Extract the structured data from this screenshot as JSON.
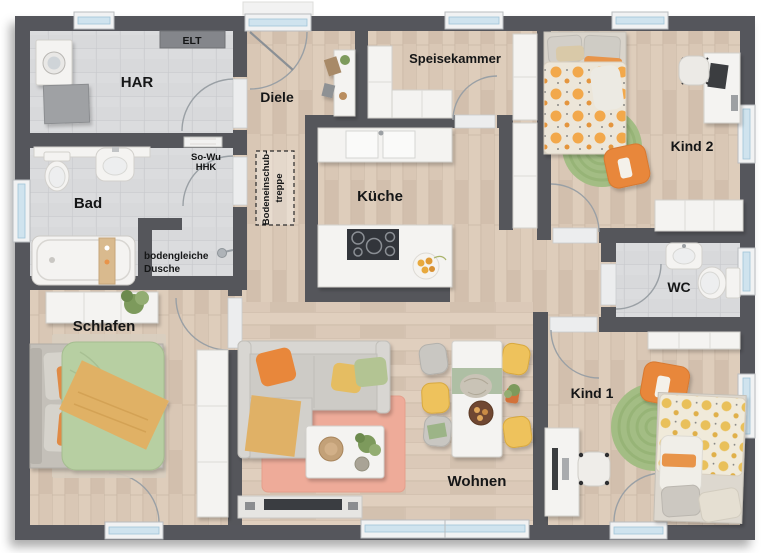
{
  "plan": {
    "rooms": {
      "har": {
        "label": "HAR"
      },
      "diele": {
        "label": "Diele"
      },
      "speisekammer": {
        "label": "Speisekammer"
      },
      "kueche": {
        "label": "Küche"
      },
      "bad": {
        "label": "Bad"
      },
      "schlafen": {
        "label": "Schlafen"
      },
      "wohnen": {
        "label": "Wohnen"
      },
      "kind1": {
        "label": "Kind 1"
      },
      "kind2": {
        "label": "Kind 2"
      },
      "wc": {
        "label": "WC"
      }
    },
    "annotations": {
      "elt": "ELT",
      "so_wu_line1": "So-Wu",
      "so_wu_line2": "HHK",
      "dusche_line1": "bodengleiche",
      "dusche_line2": "Dusche",
      "treppe_line1": "Bodeneinschub-",
      "treppe_line2": "treppe"
    },
    "colors": {
      "wall": "#55565B",
      "wood_floor": "#D9C7B5",
      "tile_floor": "#D8D9DB",
      "accent_orange": "#E8873B",
      "duvet_green": "#B7CFA2",
      "rug_green": "#9CB97E",
      "rug_pink": "#EEAB99",
      "chair_yellow": "#EEC25B",
      "window_glass": "#CFE3EE",
      "label_text": "#151617"
    }
  }
}
